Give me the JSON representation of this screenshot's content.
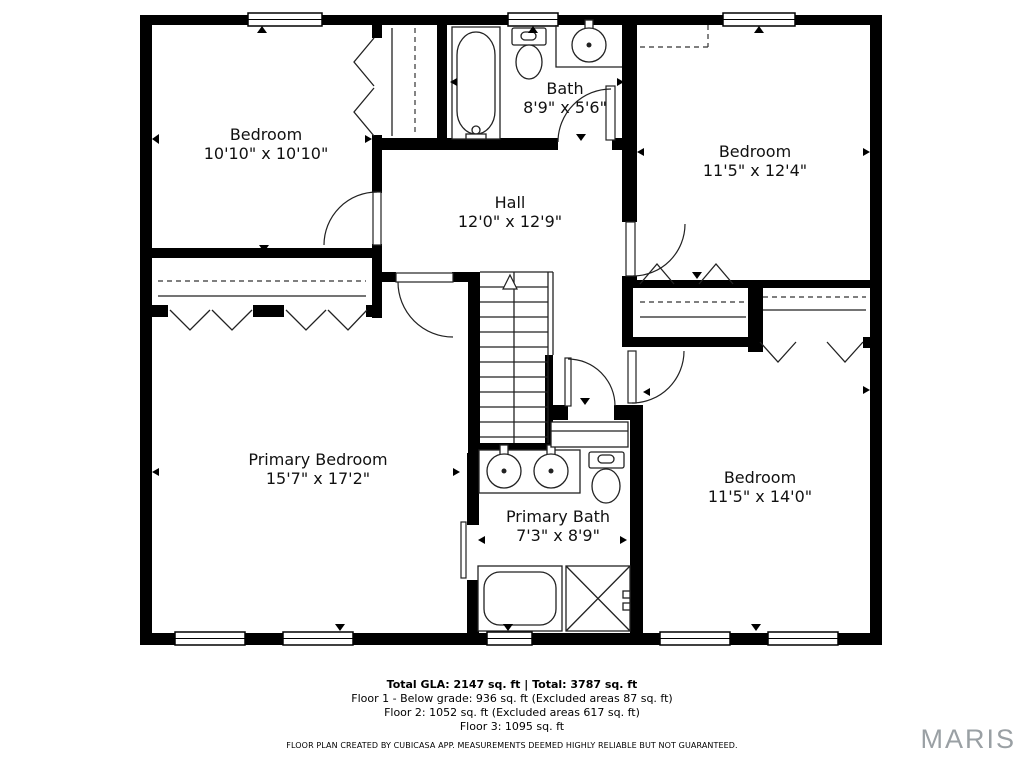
{
  "plan": {
    "floor_label": "Floor 3",
    "rooms": [
      {
        "name": "Bedroom",
        "dims": "10'10\" x 10'10\""
      },
      {
        "name": "Bath",
        "dims": "8'9\" x 5'6\""
      },
      {
        "name": "Bedroom",
        "dims": "11'5\" x 12'4\""
      },
      {
        "name": "Hall",
        "dims": "12'0\" x 12'9\""
      },
      {
        "name": "Primary Bedroom",
        "dims": "15'7\" x 17'2\""
      },
      {
        "name": "Primary Bath",
        "dims": "7'3\" x 8'9\""
      },
      {
        "name": "Bedroom",
        "dims": "11'5\" x 14'0\""
      }
    ],
    "symbols": [
      "stairs-up-arrow",
      "bathtub",
      "toilet",
      "sink",
      "double-vanity",
      "shower",
      "bifold-closet-doors",
      "windows",
      "door-swings"
    ]
  },
  "footer": {
    "total_line": "Total GLA: 2147 sq. ft | Total: 3787 sq. ft",
    "floor_lines": [
      "Floor 1 - Below grade: 936 sq. ft (Excluded areas 87 sq. ft)",
      "Floor 2: 1052 sq. ft (Excluded areas 617 sq. ft)",
      "Floor 3: 1095 sq. ft"
    ],
    "disclaimer": "FLOOR PLAN CREATED BY CUBICASA APP. MEASUREMENTS DEEMED HIGHLY RELIABLE BUT NOT GUARANTEED."
  },
  "branding": {
    "logo_text": "MARIS",
    "logo_color": "#9aa0a4"
  },
  "colors": {
    "wall": "#000000",
    "background": "#ffffff",
    "line": "#222222"
  }
}
